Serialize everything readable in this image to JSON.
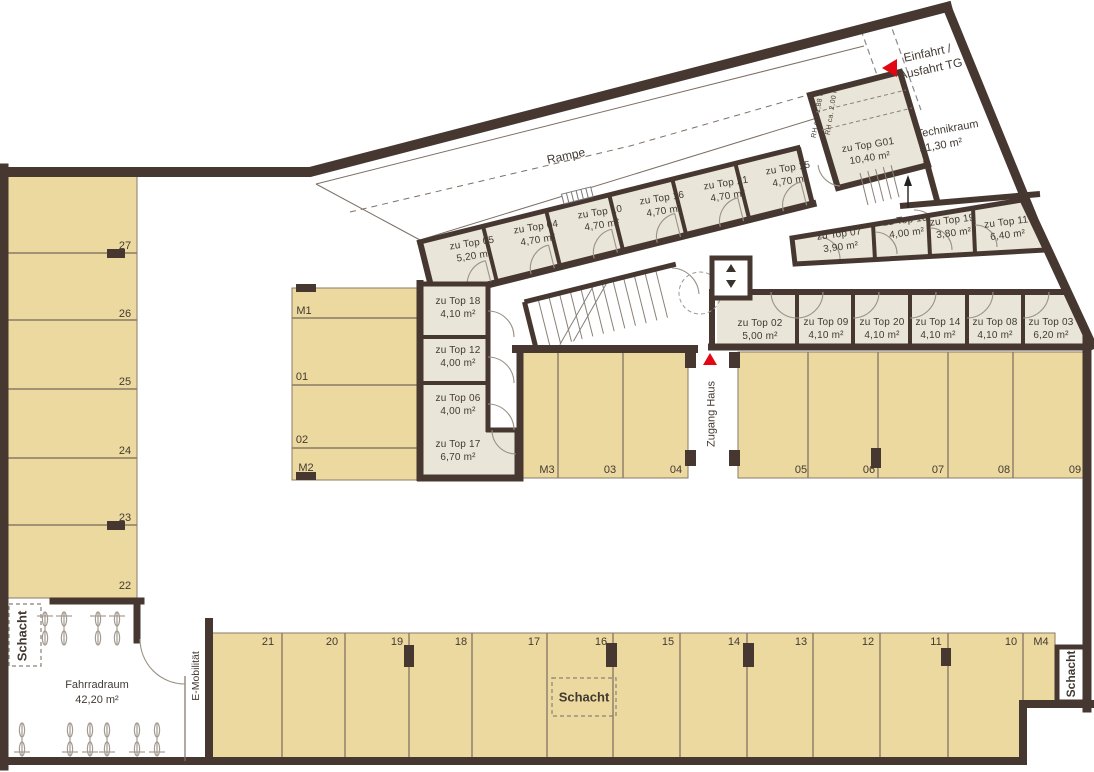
{
  "colors": {
    "wall": "#463831",
    "parking_fill": "#ecd9a0",
    "storage_fill": "#e9e5d8",
    "accent_red": "#e30613",
    "text": "#423a32"
  },
  "labels": {
    "rampe": "Rampe",
    "einfahrt_line1": "Einfahrt /",
    "einfahrt_line2": "Ausfahrt TG",
    "technikraum": "Technikraum",
    "technikraum_area": "31,30 m²",
    "zugang_haus": "Zugang Haus",
    "fahrradraum": "Fahrradraum",
    "fahrradraum_area": "42,20 m²",
    "e_mobilitaet": "E-Mobilität",
    "schacht_left": "Schacht",
    "schacht_middle": "Schacht",
    "schacht_right": "Schacht",
    "rh_2_00": "RH ca. 2,00 m",
    "rh_1_88": "RH ca. 1,88 m"
  },
  "storage": {
    "top_row": [
      {
        "name": "zu Top 05",
        "area": "5,20 m²"
      },
      {
        "name": "zu Top 04",
        "area": "4,70 m²"
      },
      {
        "name": "zu Top 10",
        "area": "4,70 m²"
      },
      {
        "name": "zu Top 16",
        "area": "4,70 m²"
      },
      {
        "name": "zu Top 21",
        "area": "4,70 m²"
      },
      {
        "name": "zu Top 15",
        "area": "4,70 m²"
      },
      {
        "name": "zu Top G01",
        "area": "10,40 m²"
      }
    ],
    "right_cluster": [
      {
        "name": "zu Top 07",
        "area": "3,90 m²"
      },
      {
        "name": "zu Top 13",
        "area": "4,00 m²"
      },
      {
        "name": "zu Top 19",
        "area": "3,80 m²"
      },
      {
        "name": "zu Top 11",
        "area": "6,40 m²"
      }
    ],
    "west_column": [
      {
        "name": "zu Top 18",
        "area": "4,10 m²"
      },
      {
        "name": "zu Top 12",
        "area": "4,00 m²"
      },
      {
        "name": "zu Top 06",
        "area": "4,00 m²"
      },
      {
        "name": "zu Top 17",
        "area": "6,70 m²"
      }
    ],
    "south_row": [
      {
        "name": "zu Top 02",
        "area": "5,00 m²"
      },
      {
        "name": "zu Top 09",
        "area": "4,10 m²"
      },
      {
        "name": "zu Top 20",
        "area": "4,10 m²"
      },
      {
        "name": "zu Top 14",
        "area": "4,10 m²"
      },
      {
        "name": "zu Top 08",
        "area": "4,10 m²"
      },
      {
        "name": "zu Top 03",
        "area": "6,20 m²"
      }
    ]
  },
  "parking": {
    "west_column": [
      "27",
      "26",
      "25",
      "24",
      "23",
      "22"
    ],
    "center_block": [
      "M1",
      "01",
      "02",
      "M2"
    ],
    "middle_row_left": [
      "M3",
      "03",
      "04"
    ],
    "middle_row_right": [
      "05",
      "06",
      "07",
      "08",
      "09"
    ],
    "south_row": [
      "21",
      "20",
      "19",
      "18",
      "17",
      "16",
      "15",
      "14",
      "13",
      "12",
      "11",
      "10",
      "M4"
    ]
  }
}
